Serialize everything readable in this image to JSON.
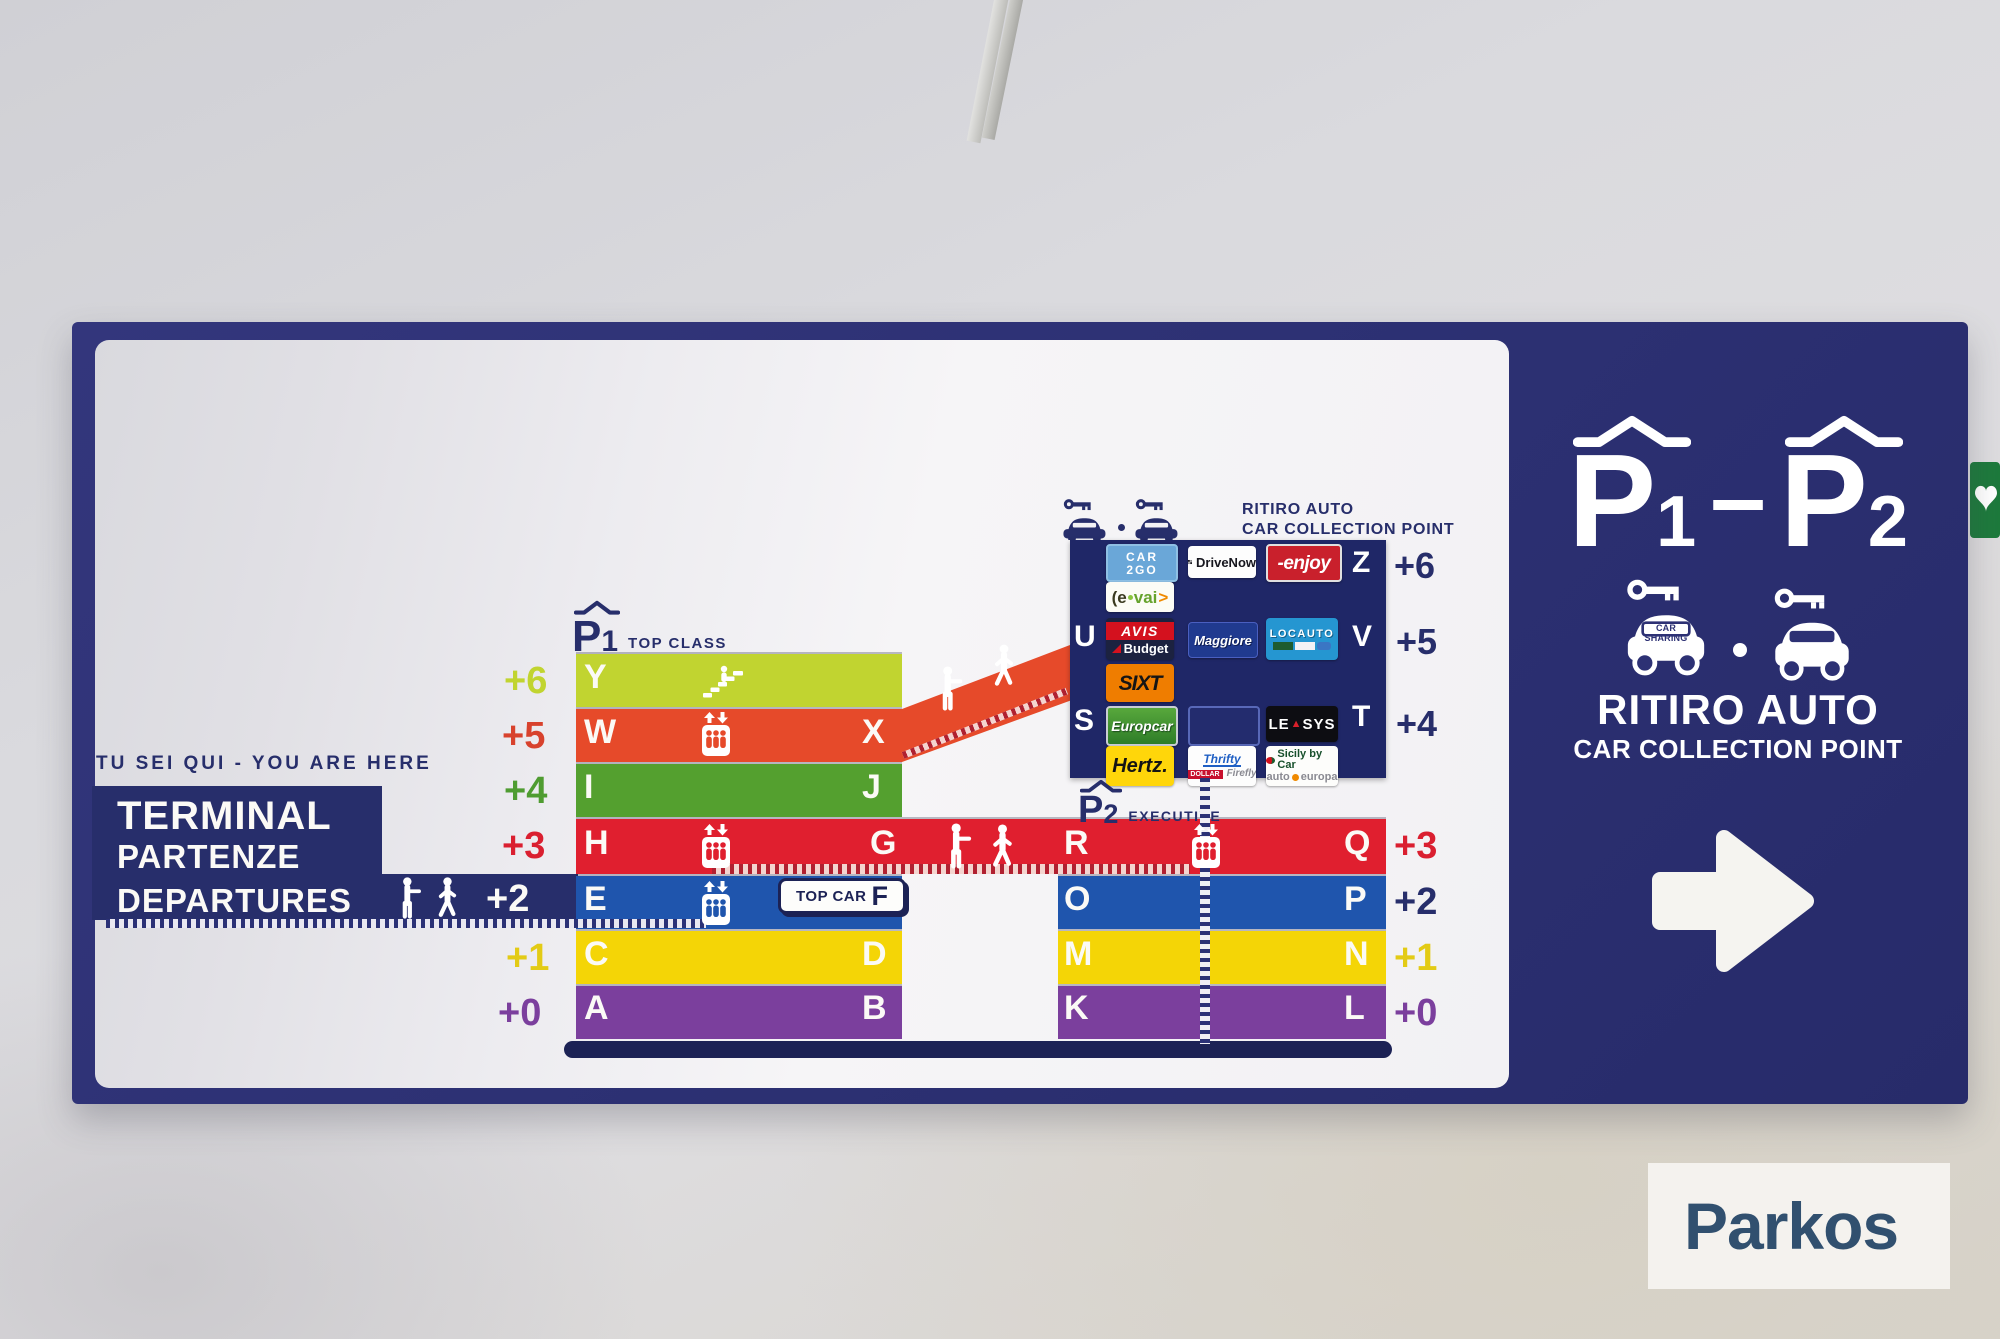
{
  "colors": {
    "board_navy": "#2d3174",
    "logo_panel_navy": "#1f2767",
    "navy": "#272e6b",
    "lime": "#c1d430",
    "orange": "#e64a2a",
    "green": "#54a02f",
    "red": "#e01f2f",
    "blue": "#1f55ad",
    "yellow": "#f4d506",
    "purple": "#7b3f9d",
    "white_panel": "#f3f2f5",
    "parkos_blue": "#31506f",
    "aed_green": "#1d7a3c"
  },
  "you_are_here": "TU SEI QUI - YOU ARE HERE",
  "terminal": {
    "line1": "TERMINAL",
    "line2": "PARTENZE",
    "line3": "DEPARTURES",
    "level": "+2"
  },
  "p1": {
    "letter": "P",
    "num": "1",
    "name": "TOP CLASS"
  },
  "p2": {
    "letter": "P",
    "num": "2",
    "name": "EXECUTIVE"
  },
  "collection_small": {
    "title": "RITIRO AUTO",
    "subtitle": "CAR COLLECTION POINT"
  },
  "floors": {
    "badge": {
      "text": "TOP CAR",
      "letter": "F"
    },
    "rows": [
      {
        "level": "+6",
        "a": "Y"
      },
      {
        "level": "+5",
        "a": "W",
        "b": "X"
      },
      {
        "level": "+4",
        "a": "I",
        "b": "J"
      },
      {
        "level": "+3",
        "a": "H",
        "b": "G",
        "c": "R",
        "d": "Q",
        "right": "+3"
      },
      {
        "level": "+2",
        "a": "E",
        "b": "O",
        "c": "P",
        "right": "+2"
      },
      {
        "level": "+1",
        "a": "C",
        "b": "D",
        "c": "M",
        "d": "N",
        "right": "+1"
      },
      {
        "level": "+0",
        "a": "A",
        "b": "B",
        "c": "K",
        "d": "L",
        "right": "+0"
      }
    ]
  },
  "grid": {
    "z": "Z",
    "u": "U",
    "v": "V",
    "s": "S",
    "t": "T",
    "lvl6": "+6",
    "lvl5": "+5",
    "lvl4": "+4",
    "car2go_top": "CAR",
    "car2go_bottom": "2GO",
    "drivenow": "DriveNow",
    "enjoy": "-enjoy",
    "evai_1": "(e",
    "evai_2": "vai",
    "evai_3": ">",
    "avis": "AVIS",
    "budget": "Budget",
    "maggiore": "Maggiore",
    "locauto": "LOCAUTO",
    "sixt": "SIXT",
    "europcar": "Europcar",
    "leasys_1": "LE",
    "leasys_tri": "▲",
    "leasys_2": "SYS",
    "hertz": "Hertz.",
    "thrifty": "Thrifty",
    "dollar": "DOLLAR",
    "firefly": "Firefly",
    "sicily": "Sicily by Car",
    "auto": "auto",
    "europa": "europa"
  },
  "right_panel": {
    "p": "P",
    "n1": "1",
    "dash": "–",
    "n2": "2",
    "car_sharing": "CAR SHARING",
    "title": "RITIRO AUTO",
    "subtitle": "CAR COLLECTION POINT"
  },
  "watermark": {
    "text": "Parkos"
  }
}
